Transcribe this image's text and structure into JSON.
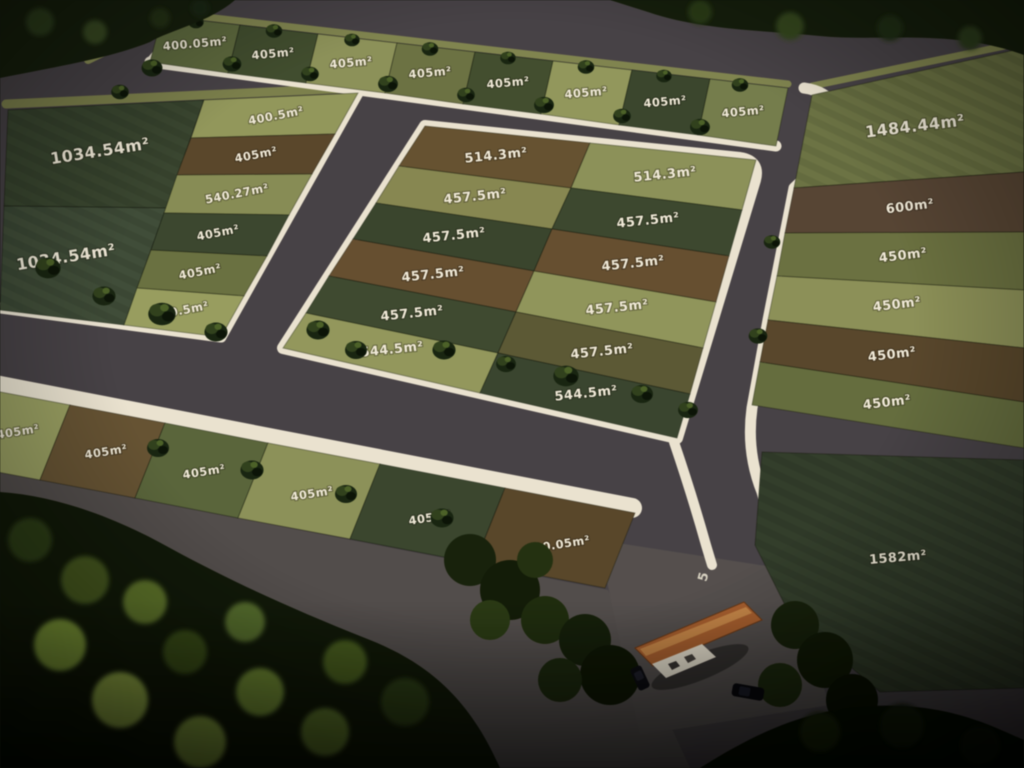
{
  "scene": {
    "type": "land-subdivision-aerial-plan",
    "road_lot_count": 41
  },
  "palette": {
    "asphalt": "#4b4549",
    "asphalt_light": "#56504e",
    "curb": "#ece4cf",
    "label_text": "#f1ead6",
    "verge_grass": "#83874d",
    "tree_dark": "#18220e",
    "tree_light": "#8aa63c",
    "house_roof": "#b2622c",
    "house_wall": "#eae2cf",
    "car_body": "#121216"
  },
  "markings": {
    "road_number": "5"
  },
  "lots": {
    "top_row": [
      {
        "label": "400.05m²",
        "color": "#5f6b3d"
      },
      {
        "label": "405m²",
        "color": "#43512f"
      },
      {
        "label": "405m²",
        "color": "#8f9456"
      },
      {
        "label": "405m²",
        "color": "#6f7542"
      },
      {
        "label": "405m²",
        "color": "#45522f"
      },
      {
        "label": "405m²",
        "color": "#949a59"
      },
      {
        "label": "405m²",
        "color": "#3d4a2e"
      },
      {
        "label": "405m²",
        "color": "#77804a"
      }
    ],
    "left_block": {
      "large": [
        {
          "label": "1034.54m²",
          "color": "#3c4a31"
        },
        {
          "label": "1034.54m²",
          "color": "#42513a"
        }
      ],
      "small": [
        {
          "label": "400.5m²",
          "color": "#959a58"
        },
        {
          "label": "405m²",
          "color": "#5f4a2b"
        },
        {
          "label": "540.27m²",
          "color": "#8a8f52"
        },
        {
          "label": "405m²",
          "color": "#3e4b30"
        },
        {
          "label": "405m²",
          "color": "#6d743f"
        },
        {
          "label": "400.5m²",
          "color": "#9aa05c"
        }
      ]
    },
    "center_block": {
      "left": [
        {
          "label": "514.3m²",
          "color": "#6b5530"
        },
        {
          "label": "457.5m²",
          "color": "#8a8a4f"
        },
        {
          "label": "457.5m²",
          "color": "#3c492e"
        },
        {
          "label": "457.5m²",
          "color": "#6b5230"
        },
        {
          "label": "457.5m²",
          "color": "#414e31"
        },
        {
          "label": "544.5m²",
          "color": "#959a59"
        }
      ],
      "right": [
        {
          "label": "514.3m²",
          "color": "#8e9456"
        },
        {
          "label": "457.5m²",
          "color": "#3f4c30"
        },
        {
          "label": "457.5m²",
          "color": "#6b5230"
        },
        {
          "label": "457.5m²",
          "color": "#939858"
        },
        {
          "label": "457.5m²",
          "color": "#5f5c35"
        },
        {
          "label": "544.5m²",
          "color": "#3c4930"
        }
      ]
    },
    "right_column": [
      {
        "label": "1484.44m²",
        "color": "#6f7643"
      },
      {
        "label": "600m²",
        "color": "#5c4835"
      },
      {
        "label": "450m²",
        "color": "#6e743f"
      },
      {
        "label": "450m²",
        "color": "#8f9355"
      },
      {
        "label": "450m²",
        "color": "#5e4a2c"
      },
      {
        "label": "450m²",
        "color": "#68703d"
      }
    ],
    "bottom_row": [
      {
        "label": "405m²",
        "color": "#9aa05e"
      },
      {
        "label": "405m²",
        "color": "#6b5633"
      },
      {
        "label": "405m²",
        "color": "#5c683a"
      },
      {
        "label": "405m²",
        "color": "#8f9456"
      },
      {
        "label": "405m²",
        "color": "#3d4a2f"
      },
      {
        "label": "400.05m²",
        "color": "#5e4a2a"
      }
    ],
    "outlying": [
      {
        "label": "1582m²",
        "color": "#36422d"
      }
    ]
  }
}
